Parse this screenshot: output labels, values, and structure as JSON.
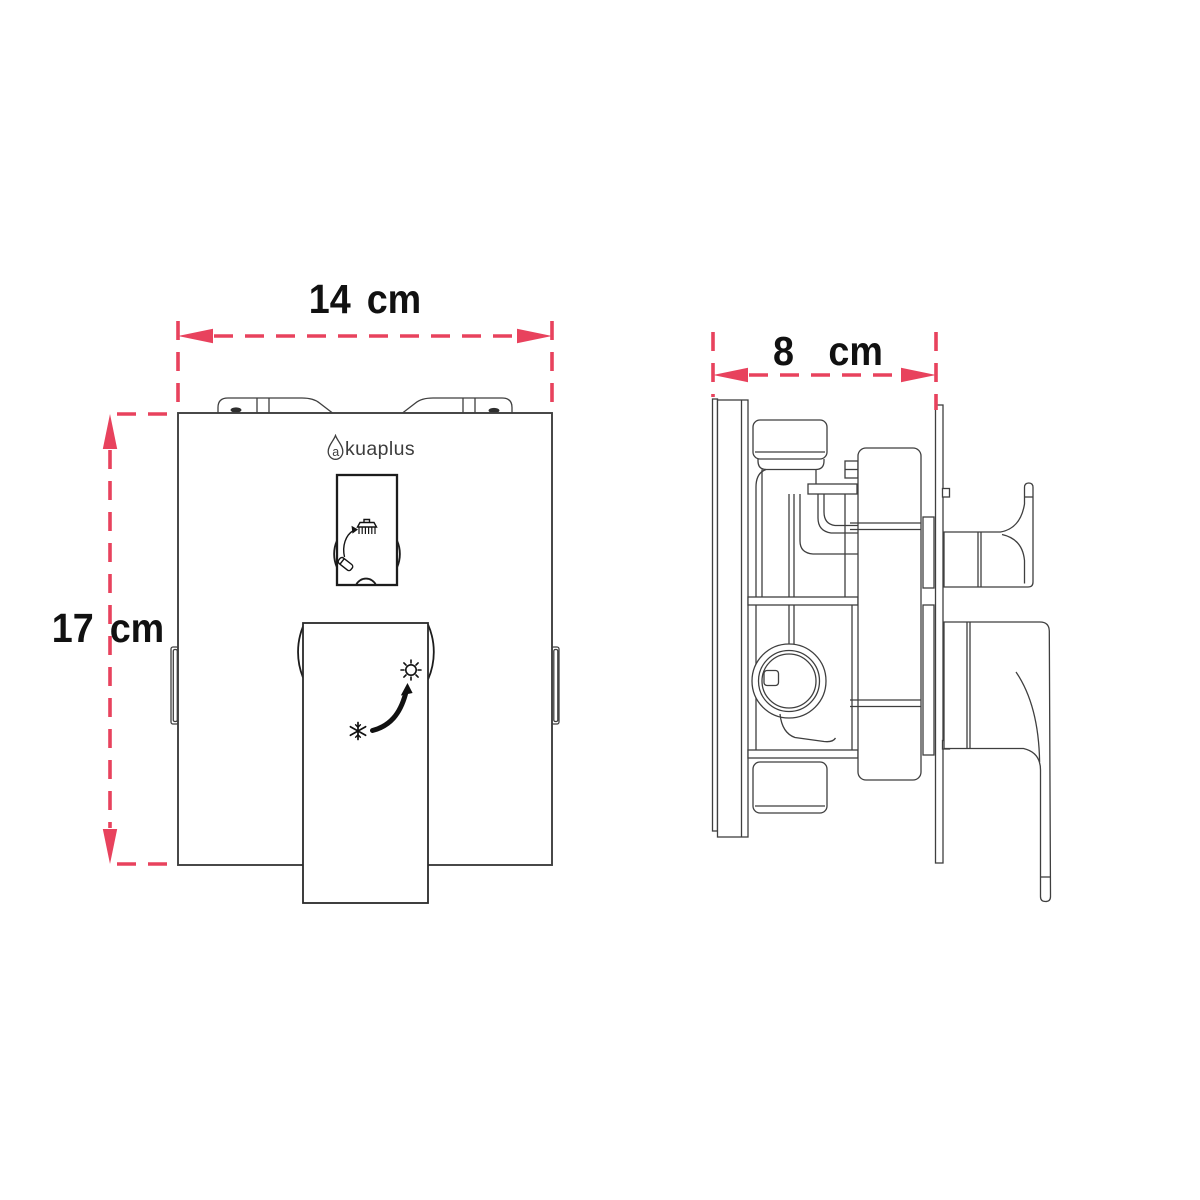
{
  "brand": {
    "initial": "a",
    "rest": "kuaplus",
    "full_name": "akuaplus"
  },
  "dimensions": {
    "width": {
      "label": "14 cm",
      "value": 14,
      "unit": "cm"
    },
    "height": {
      "label": "17 cm",
      "value": 17,
      "unit": "cm"
    },
    "depth": {
      "label": "8 cm",
      "value": 8,
      "unit": "cm"
    }
  },
  "colors": {
    "dimension_accent": "#e8425d",
    "drawing_line": "#3f3f3f",
    "background": "#ffffff",
    "label_text": "#111111"
  },
  "icons": {
    "brand_logo": "water-drop-icon",
    "diverter_window": [
      "shower-head-icon",
      "diverter-curved-arrow-icon",
      "tub-spout-icon"
    ],
    "lever_face": [
      "snowflake-cold-icon",
      "temperature-rotate-arrow-icon",
      "sun-hot-icon"
    ]
  }
}
